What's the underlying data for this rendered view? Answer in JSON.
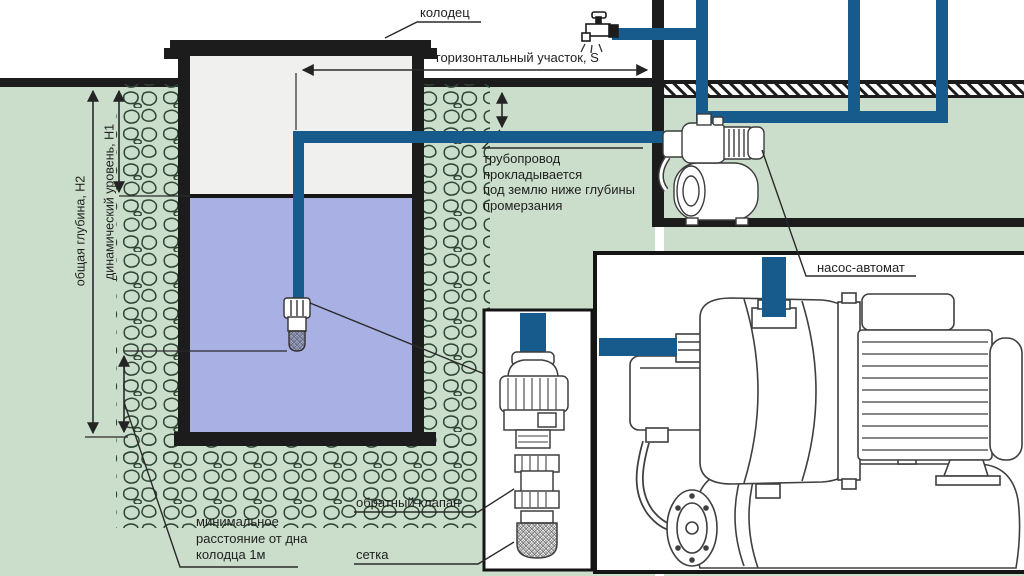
{
  "labels": {
    "well": "колодец",
    "horizontal_section": "горизонтальный участок, S",
    "pipeline_note": {
      "line1": "трубопровод",
      "line2": "прокладывается",
      "line3": "под землю ниже глубины",
      "line4": "промерзания"
    },
    "pump_station": "насос-автомат",
    "check_valve": "обратный клапан",
    "mesh": "сетка",
    "min_distance": {
      "line1": "минимальное",
      "line2": "расстояние от дна",
      "line3": "колодца 1м"
    },
    "total_depth": "общая глубина, Н2",
    "dynamic_level": "динамический уровень, Н1"
  },
  "colors": {
    "ground_green": "#cbdecb",
    "water_blue": "#a9b1e4",
    "pipe_blue": "#175b8d",
    "outline_black": "#1c1c1c",
    "well_interior": "#f0f0ee",
    "stone_outline": "#2e4636",
    "box_fill": "#ffffff"
  }
}
